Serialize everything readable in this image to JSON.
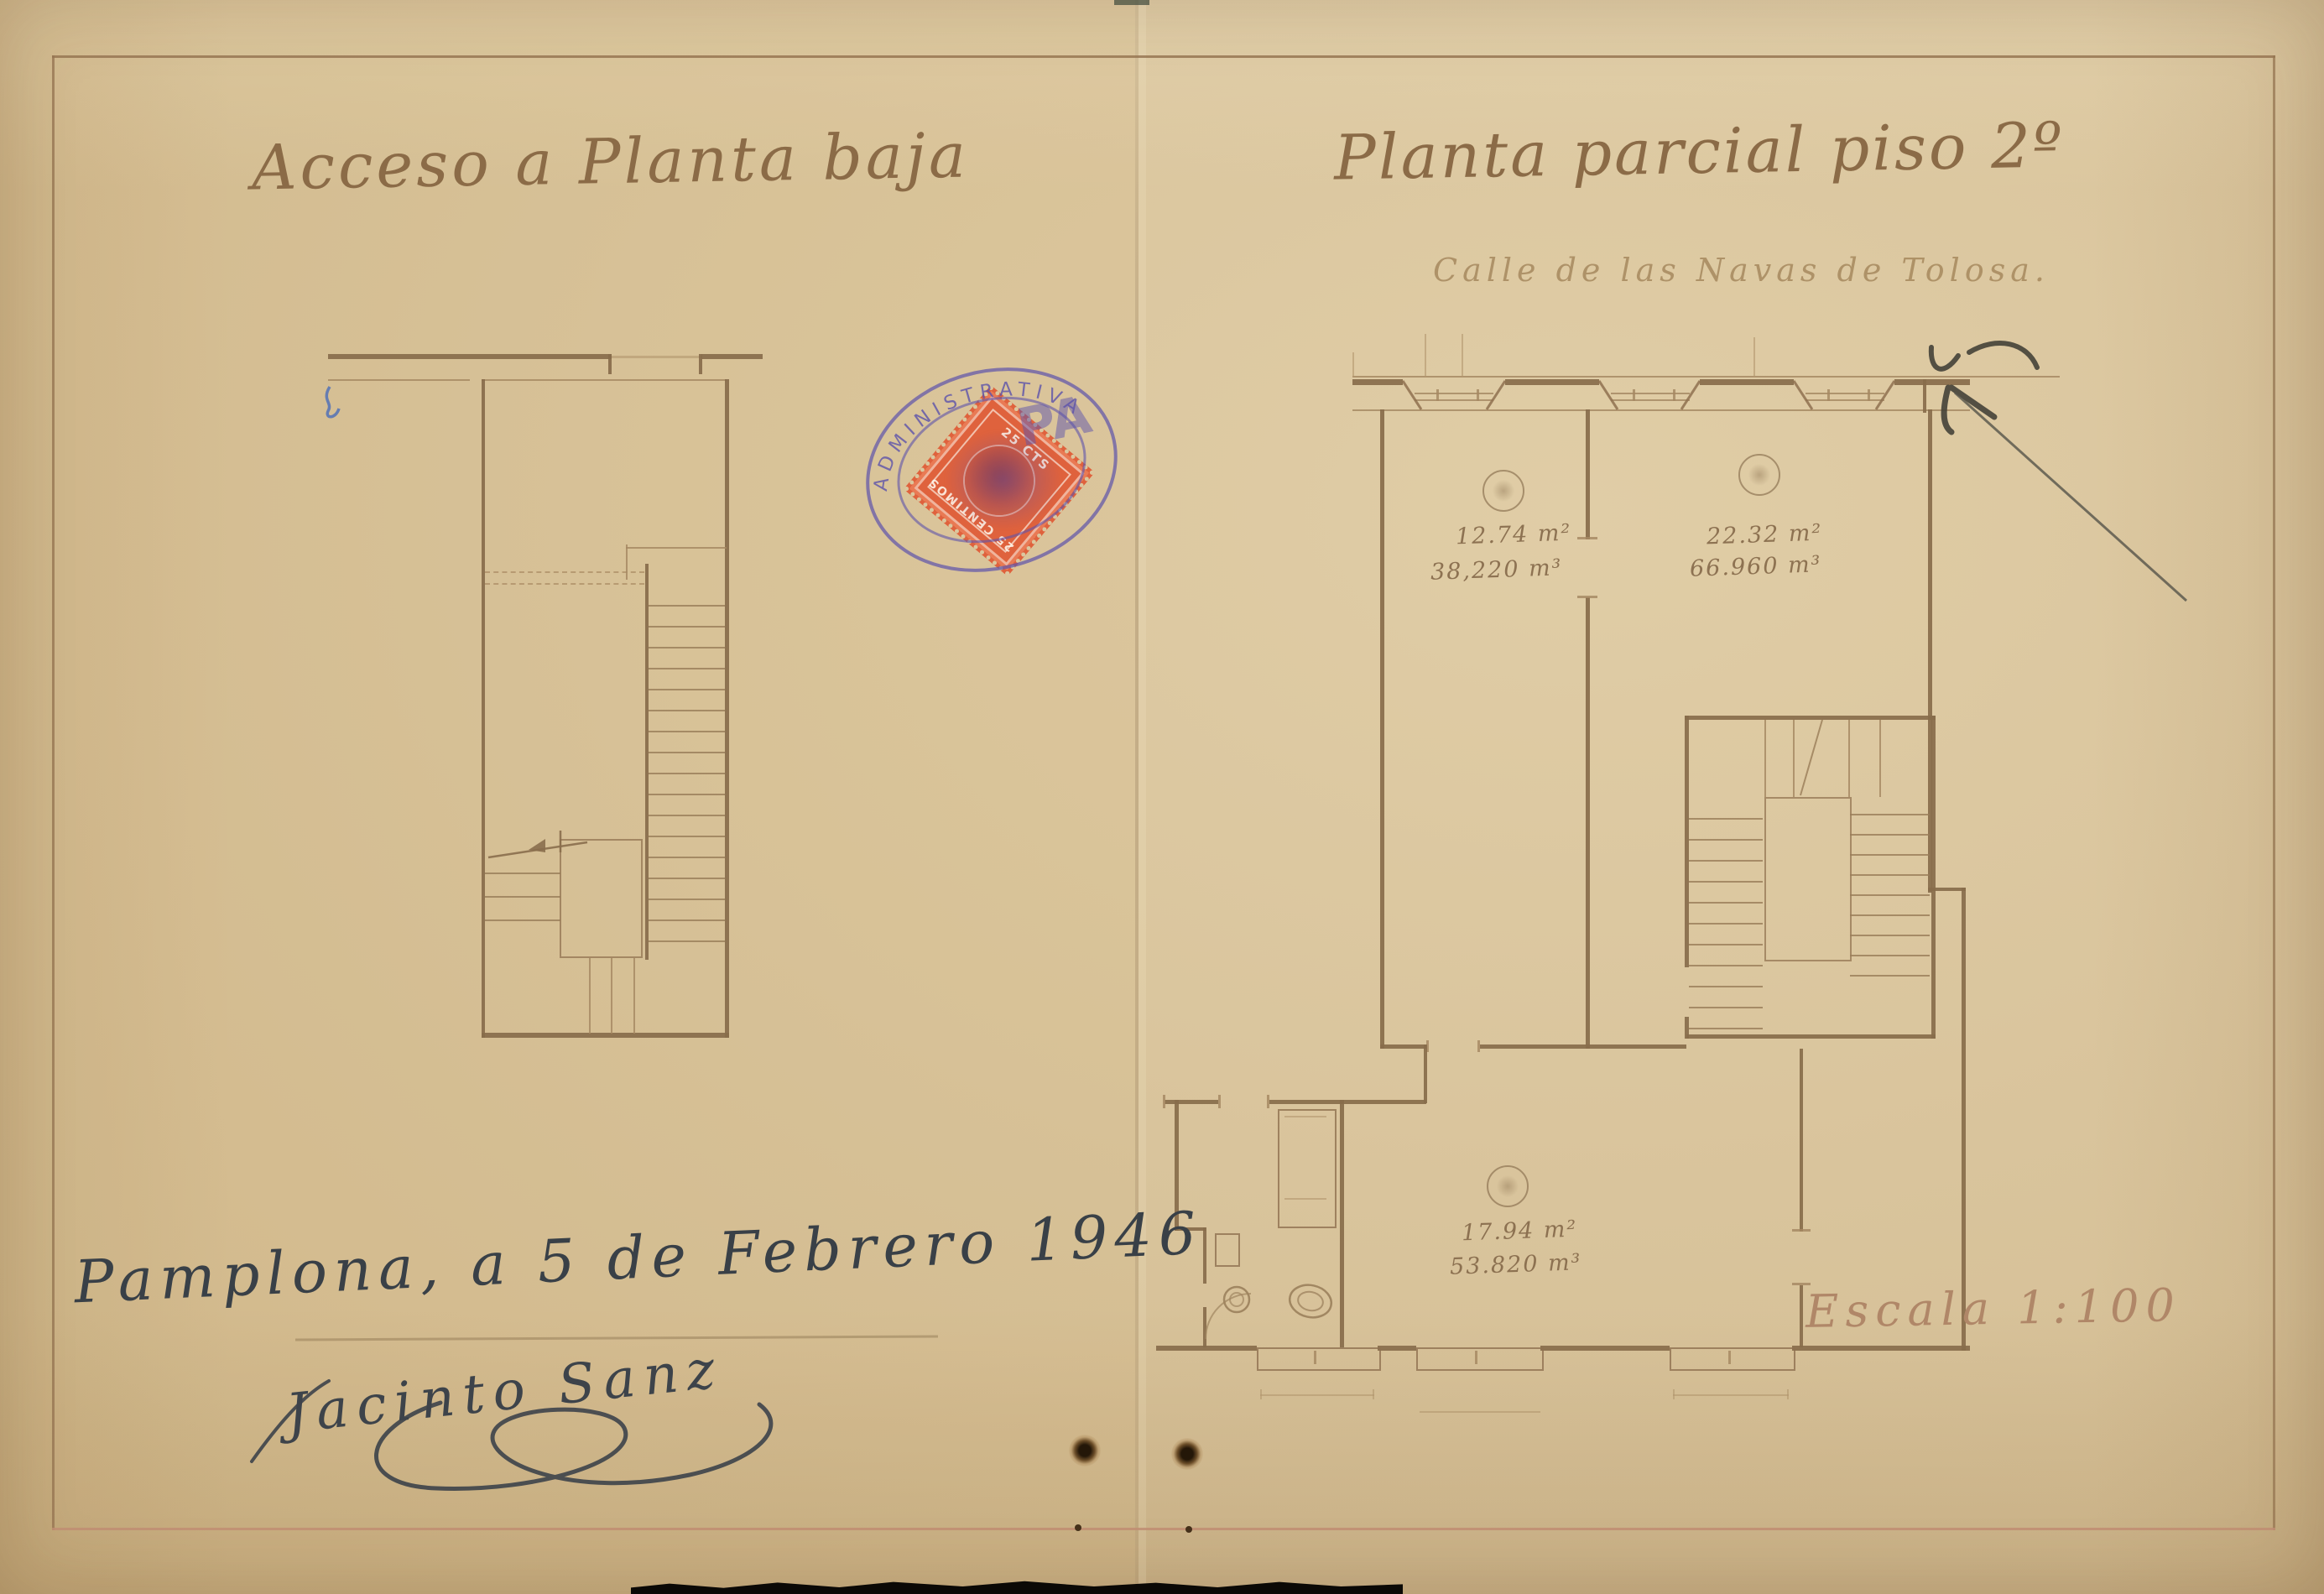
{
  "page": {
    "left_title": "Acceso a Planta baja",
    "right_title": "Planta parcial piso 2º",
    "street_label": "Calle de las Navas de Tolosa.",
    "scale_label": "Escala 1:100",
    "date_line": "Pamplona, a 5 de Febrero 1946",
    "signature_name": "Jacinto Sanz",
    "rooms": [
      {
        "area": "12.74 m²",
        "volume": "38,220 m³"
      },
      {
        "area": "22.32 m²",
        "volume": "66.960 m³"
      },
      {
        "area": "17.94 m²",
        "volume": "53.820 m³"
      }
    ],
    "stamp": {
      "top_text": "25 CTS",
      "bottom_text": "25 CENTIMOS",
      "overprint_arc_text": "ADMINISTRATIVA",
      "overprint_big_text": "PA",
      "stamp_color": "#e05f3a",
      "overprint_color": "#5d53ab"
    },
    "colors": {
      "paper": "#d9c49c",
      "plan_ink": "#886c4b",
      "title_ink": "#8b6b47",
      "pen_ink": "#394047",
      "pencil": "#413f36",
      "border_top": "#96755a",
      "border_bottom": "#c08d72"
    }
  }
}
